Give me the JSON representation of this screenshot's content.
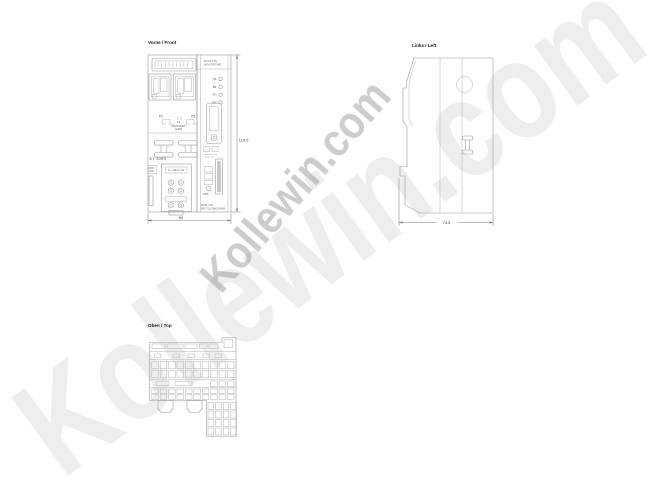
{
  "watermark": {
    "text": "Kollewin.com"
  },
  "front": {
    "title": "Vorne / Front",
    "type1": "IM 151-3 PN",
    "type2": "HIGH FEATURE",
    "leds": [
      "SF",
      "BF",
      "ON",
      "PW"
    ],
    "port1": "P1",
    "port2": "P2",
    "iface1": "X1",
    "iface2": "PROFINET",
    "iface3": "(LAN)",
    "series": "ET 200S",
    "mac1": "MAC",
    "mac2": "ADD",
    "term_header": "1L+ 1M 2L+ 2M",
    "pwr": "PWR",
    "order1": "IM151-3 PN",
    "order2": "6ES7 151-3BA23-0AB0",
    "dim_height": "119.5",
    "dim_width": "60"
  },
  "left": {
    "title": "Links / Left",
    "dim_depth": "74.5"
  },
  "top": {
    "title": "Oben / Top"
  }
}
